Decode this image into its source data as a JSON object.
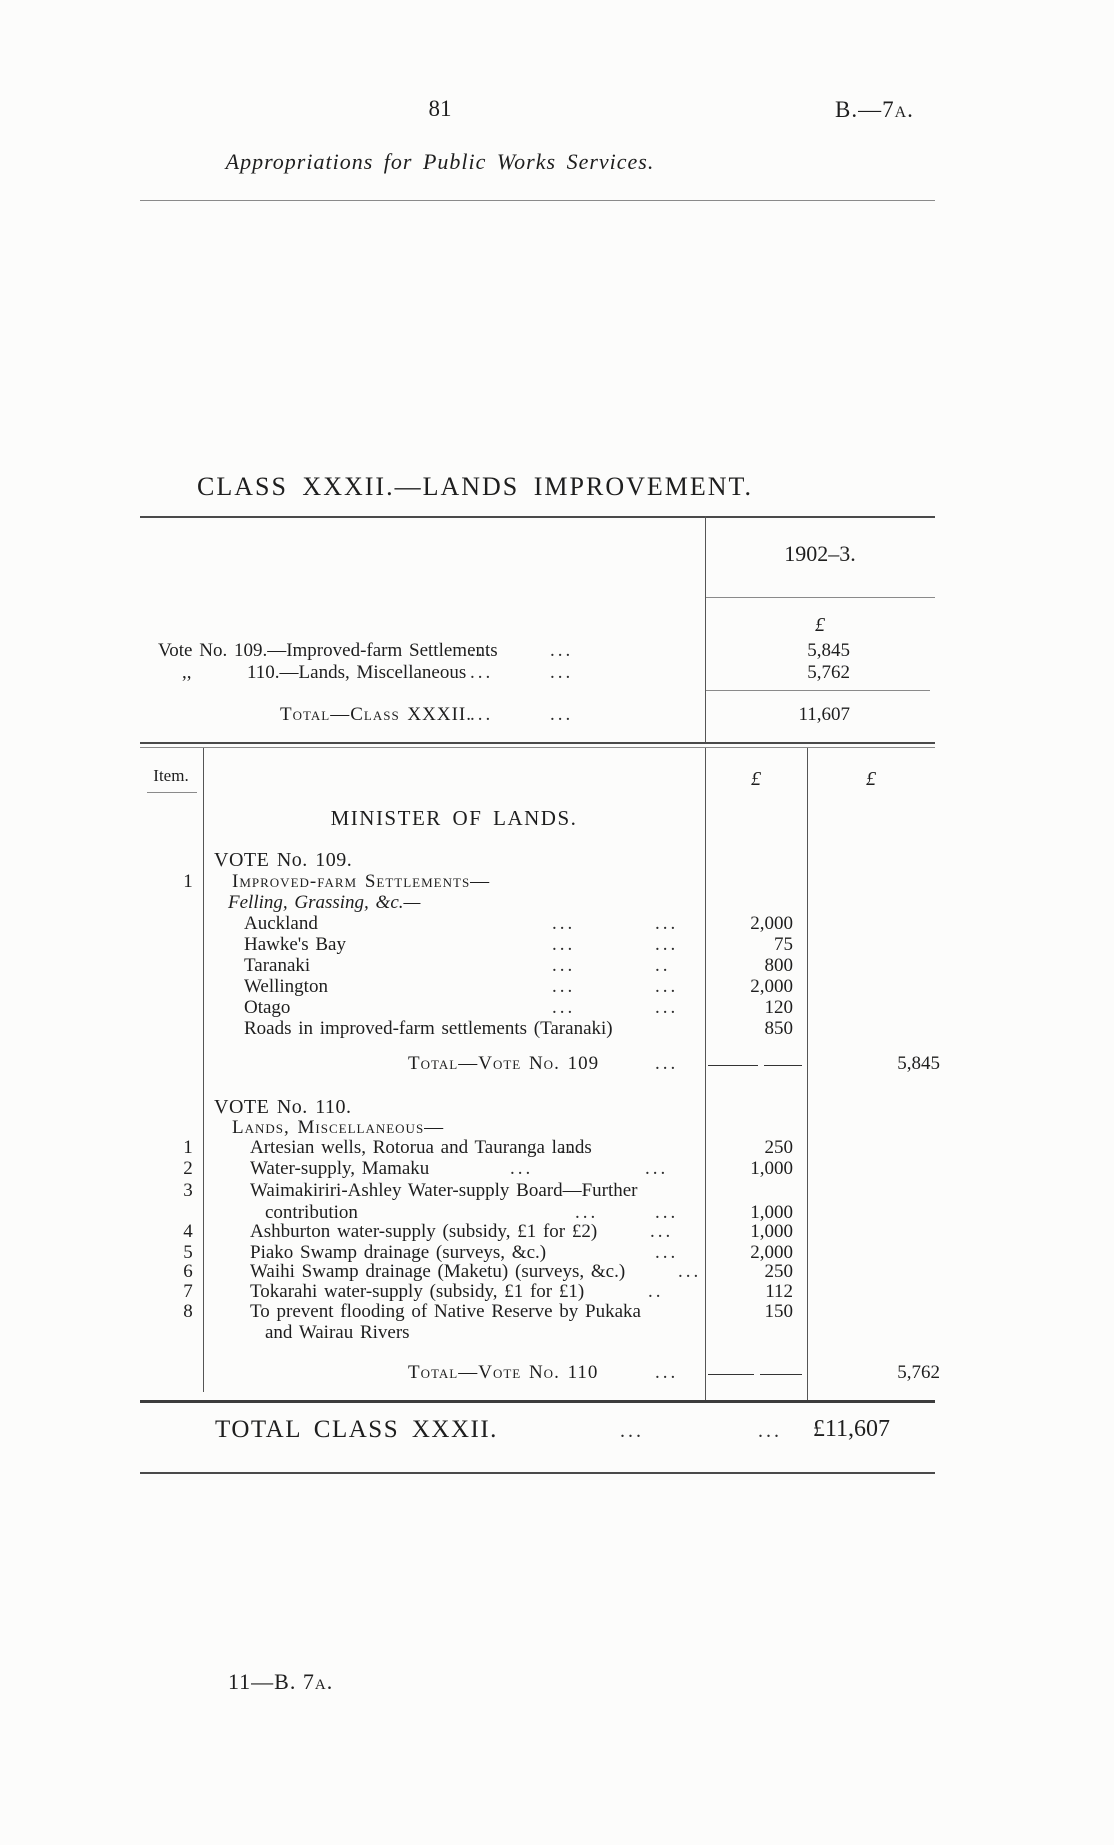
{
  "page": {
    "number": "81",
    "ref": "B.—7a.",
    "running_title": "Appropriations for Public Works Services.",
    "footer": "11—B. 7a."
  },
  "heading": "CLASS XXXII.—LANDS IMPROVEMENT.",
  "glyphs": {
    "pound": "£",
    "dots": "...",
    "dots2": ".."
  },
  "summary": {
    "year_header": "1902–3.",
    "row1": {
      "label": "Vote No. 109.—Improved-farm Settlements",
      "amount": "5,845"
    },
    "row2": {
      "ditto": ",,",
      "label": "110.—Lands, Miscellaneous",
      "amount": "5,762"
    },
    "total": {
      "label": "Total—Class XXXII.",
      "amount": "11,607"
    }
  },
  "detail": {
    "item_header": "Item.",
    "minister": "MINISTER OF LANDS.",
    "vote109": {
      "heading": "VOTE No. 109.",
      "item_no": "1",
      "group": "Improved-farm Settlements—",
      "subgroup": "Felling, Grassing, &c.—",
      "rows": [
        {
          "label": "Auckland",
          "amount": "2,000"
        },
        {
          "label": "Hawke's Bay",
          "amount": "75"
        },
        {
          "label": "Taranaki",
          "amount": "800"
        },
        {
          "label": "Wellington",
          "amount": "2,000"
        },
        {
          "label": "Otago",
          "amount": "120"
        },
        {
          "label": "Roads in improved-farm settlements (Taranaki)",
          "amount": "850"
        }
      ],
      "total_label": "Total—Vote No. 109",
      "total_amount": "5,845"
    },
    "vote110": {
      "heading": "VOTE No. 110.",
      "group": "Lands, Miscellaneous—",
      "rows": [
        {
          "no": "1",
          "label": "Artesian wells, Rotorua and Tauranga lands",
          "amount": "250"
        },
        {
          "no": "2",
          "label": "Water-supply, Mamaku",
          "amount": "1,000"
        },
        {
          "no": "3",
          "label": "Waimakiriri-Ashley Water-supply Board—Further",
          "label2": "contribution",
          "amount": "1,000"
        },
        {
          "no": "4",
          "label": "Ashburton water-supply (subsidy, £1 for £2)",
          "amount": "1,000"
        },
        {
          "no": "5",
          "label": "Piako Swamp drainage (surveys, &c.)",
          "amount": "2,000"
        },
        {
          "no": "6",
          "label": "Waihi Swamp drainage (Maketu) (surveys, &c.)",
          "amount": "250"
        },
        {
          "no": "7",
          "label": "Tokarahi water-supply (subsidy, £1 for £1)",
          "amount": "112"
        },
        {
          "no": "8",
          "label": "To prevent flooding of Native Reserve by Pukaka",
          "label2": "and Wairau Rivers",
          "amount": "150"
        }
      ],
      "total_label": "Total—Vote No. 110",
      "total_amount": "5,762"
    }
  },
  "grand_total": {
    "label": "TOTAL CLASS XXXII.",
    "amount": "£11,607"
  }
}
